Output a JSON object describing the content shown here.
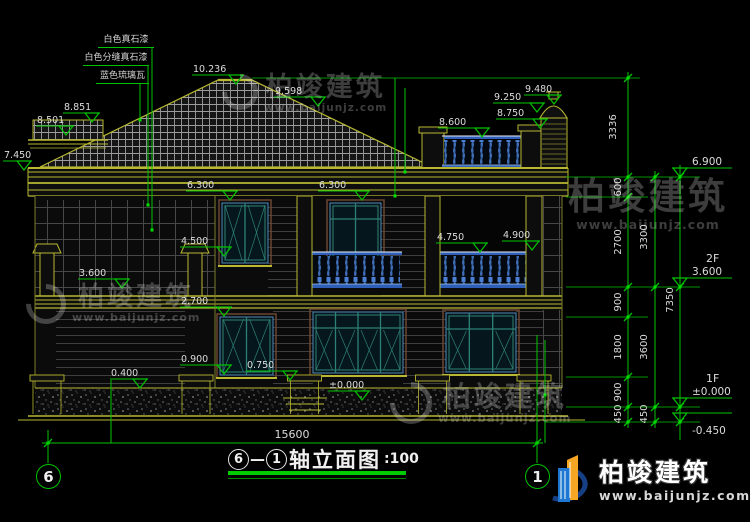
{
  "colors": {
    "yellow": "#b8b832",
    "green": "#00c300",
    "green_bright": "#00e000",
    "text": "#dcdcdc",
    "teal": "#2e8076",
    "win_blue": "#4f88b8",
    "win_brown": "#6b4632",
    "bal_blue": "#4a7fd4",
    "bal_light": "#b8d0f0",
    "logo_blue": "#1e78d2",
    "logo_orange": "#f5a623"
  },
  "watermark": {
    "brand": "柏竣建筑",
    "url": "www.baijunjz.com"
  },
  "logo": {
    "brand": "柏竣建筑",
    "url": "www.baijunjz.com"
  },
  "title": {
    "axis_from": "6",
    "axis_to": "1",
    "dash": "—",
    "name": "轴立面图",
    "scale": ":100"
  },
  "axis_bubbles": {
    "left": "6",
    "right": "1"
  },
  "materials": [
    {
      "text": "白色真石漆"
    },
    {
      "text": "白色分缝真石漆"
    },
    {
      "text": "蓝色琉璃瓦"
    }
  ],
  "overall_dim": "15600",
  "level_markers": [
    {
      "t": "10.236",
      "x": 236,
      "y": 84
    },
    {
      "t": "9.598",
      "x": 318,
      "y": 106
    },
    {
      "t": "8.851",
      "x": 92,
      "y": 122,
      "lx": 29
    },
    {
      "t": "8.501",
      "x": 66,
      "y": 135,
      "lx": 30
    },
    {
      "t": "7.450",
      "x": 24,
      "y": 170,
      "lx": 21
    },
    {
      "t": "8.600",
      "x": 482,
      "y": 137
    },
    {
      "t": "8.750",
      "x": 540,
      "y": 128
    },
    {
      "t": "9.250",
      "x": 537,
      "y": 112
    },
    {
      "t": "9.480",
      "x": 554,
      "y": 104,
      "lx": 30
    },
    {
      "t": "6.300",
      "x": 230,
      "y": 200
    },
    {
      "t": "6.300",
      "x": 362,
      "y": 200
    },
    {
      "t": "4.500",
      "x": 224,
      "y": 256
    },
    {
      "t": "4.750",
      "x": 480,
      "y": 252
    },
    {
      "t": "4.900",
      "x": 532,
      "y": 250,
      "lx": 30
    },
    {
      "t": "3.600",
      "x": 122,
      "y": 288
    },
    {
      "t": "2.700",
      "x": 224,
      "y": 316
    },
    {
      "t": "0.900",
      "x": 224,
      "y": 374
    },
    {
      "t": "0.750",
      "x": 290,
      "y": 380
    },
    {
      "t": "0.400",
      "x": 140,
      "y": 388,
      "lx": 30
    },
    {
      "t": "±0.000",
      "x": 362,
      "y": 400,
      "lx": 34
    }
  ],
  "right_markers": [
    {
      "t": "6.900",
      "y": 177
    },
    {
      "t": "3.600",
      "y": 287,
      "sub": "2F"
    },
    {
      "t": "±0.000",
      "y": 407,
      "sub": "1F"
    },
    {
      "t": "-0.450",
      "y": 422,
      "below": true
    }
  ],
  "chain_labels": [
    {
      "t": "3336",
      "x": 616,
      "y": 127
    },
    {
      "t": "600",
      "x": 621,
      "y": 187
    },
    {
      "t": "2700",
      "x": 621,
      "y": 242
    },
    {
      "t": "900",
      "x": 621,
      "y": 302
    },
    {
      "t": "1800",
      "x": 621,
      "y": 347
    },
    {
      "t": "900",
      "x": 621,
      "y": 392
    },
    {
      "t": "450",
      "x": 621,
      "y": 414
    },
    {
      "t": "3300",
      "x": 647,
      "y": 237
    },
    {
      "t": "3600",
      "x": 647,
      "y": 347
    },
    {
      "t": "450",
      "x": 647,
      "y": 414
    },
    {
      "t": "7350",
      "x": 673,
      "y": 300
    }
  ]
}
